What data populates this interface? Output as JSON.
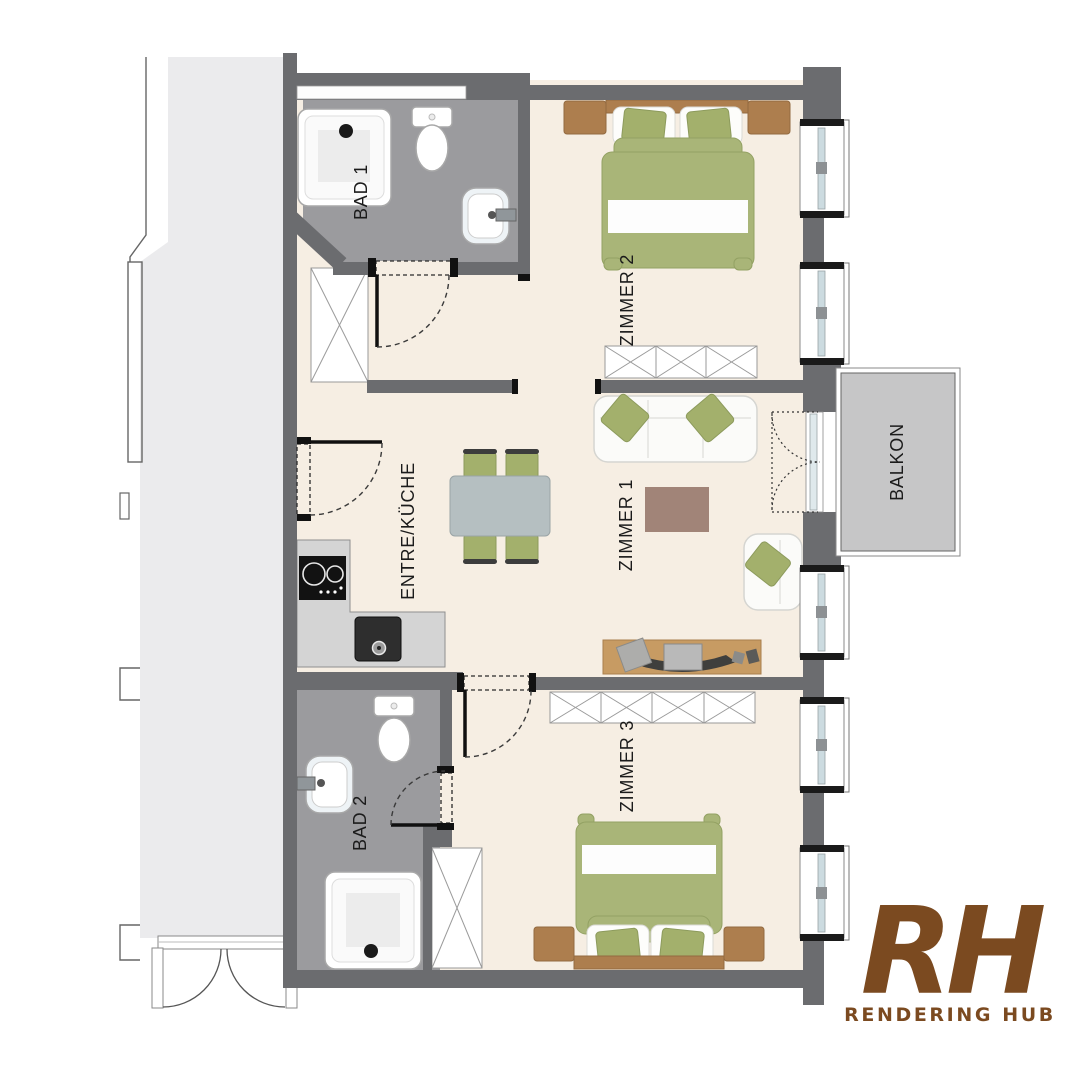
{
  "plan": {
    "room_labels": {
      "bad1": "BAD 1",
      "zimmer2": "ZIMMER 2",
      "zimmer1": "ZIMMER 1",
      "entre_kueche": "ENTRE/KÜCHE",
      "balkon": "BALKON",
      "bad2": "BAD 2",
      "zimmer3": "ZIMMER 3"
    },
    "colors": {
      "wall": "#6b6c6f",
      "apartment_floor": "#f6eee3",
      "bathroom_floor": "#9b9b9e",
      "balcony_floor": "#c6c6c7",
      "stairwell_floor": "#ebebed",
      "upholstery_green": "#a9b578",
      "wood_brown": "#ad7e4e",
      "rug_mauve": "#a18478",
      "logo_brown": "#7b4a20"
    }
  },
  "branding": {
    "monogram": "RH",
    "name": "RENDERING HUB"
  }
}
